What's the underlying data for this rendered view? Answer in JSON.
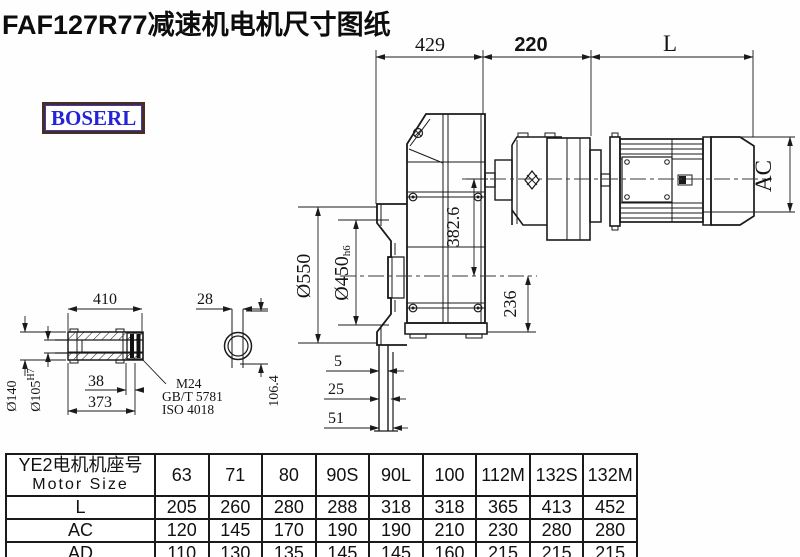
{
  "title": "FAF127R77减速机电机尺寸图纸",
  "logo": {
    "text": "BOSERL"
  },
  "drawing": {
    "dims": {
      "top_429": "429",
      "top_220": "220",
      "top_L": "L",
      "ac": "AC",
      "d550": "Ø550",
      "d450": "Ø450",
      "d450_tol": "h6",
      "v382": "382.6",
      "v236": "236",
      "shaft_410": "410",
      "shaft_28": "28",
      "d140": "Ø140",
      "d105": "Ø105",
      "d105_tol": "H7",
      "shaft_38": "38",
      "shaft_373": "373",
      "thread": "M24",
      "std1": "GB/T 5781",
      "std2": "ISO 4018",
      "v106": "106.4",
      "f5": "5",
      "f25": "25",
      "f51": "51"
    }
  },
  "table": {
    "header": {
      "zh": "YE2电机机座号",
      "en": "Motor Size"
    },
    "columns": [
      "63",
      "71",
      "80",
      "90S",
      "90L",
      "100",
      "112M",
      "132S",
      "132M"
    ],
    "rows": [
      {
        "label": "L",
        "values": [
          "205",
          "260",
          "280",
          "288",
          "318",
          "318",
          "365",
          "413",
          "452"
        ]
      },
      {
        "label": "AC",
        "values": [
          "120",
          "145",
          "170",
          "190",
          "190",
          "210",
          "230",
          "280",
          "280"
        ]
      },
      {
        "label": "AD",
        "values": [
          "110",
          "130",
          "135",
          "145",
          "145",
          "160",
          "215",
          "215",
          "215"
        ]
      }
    ]
  }
}
